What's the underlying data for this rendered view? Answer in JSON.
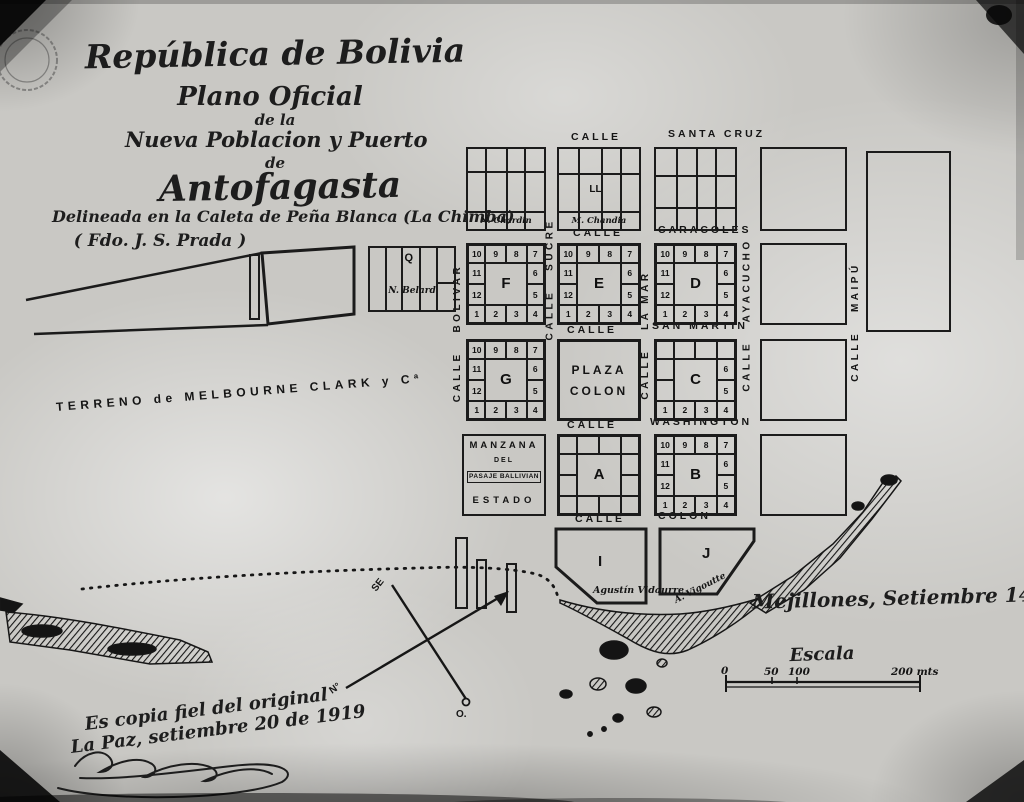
{
  "title": {
    "country": "República de Bolivia",
    "line2": "Plano Oficial",
    "line3": "de la",
    "line4": "Nueva Poblacion y Puerto",
    "line5": "de",
    "city": "Antofagasta",
    "subtitle": "Delineada en la Caleta de Peña Blanca (La Chimba)",
    "signed": "( Fdo. J. S. Prada )"
  },
  "region_label": "TERRENO de MELBOURNE CLARK y Cª",
  "streets": {
    "h": [
      {
        "l": "CALLE",
        "r": "SANTA CRUZ"
      },
      {
        "l": "CALLE",
        "r": "CARACOLES"
      },
      {
        "l": "CALLE",
        "r": "SAN MARTIN"
      },
      {
        "l": "CALLE",
        "r": "WASHINGTON"
      },
      {
        "l": "CALLE",
        "r": "COLON"
      }
    ],
    "v": [
      {
        "name": "CALLE   BOLIVAR"
      },
      {
        "name": "CALLE   SUCRE"
      },
      {
        "name": "CALLE   LA MAR"
      },
      {
        "name": "CALLE   AYACUCHO"
      },
      {
        "name": "CALLE   MAIPÚ"
      }
    ]
  },
  "plaza": {
    "l1": "PLAZA",
    "l2": "COLON"
  },
  "lots": {
    "top": [
      "10",
      "9",
      "8",
      "7"
    ],
    "left": [
      "11",
      "12"
    ],
    "right": [
      "6",
      "5"
    ],
    "bottom": [
      "1",
      "2",
      "3",
      "4"
    ]
  },
  "blocks": {
    "f": "F",
    "e": "E",
    "d": "D",
    "g": "G",
    "c": "C",
    "a": "A",
    "b": "B",
    "i": "I",
    "j": "J",
    "q": "Q",
    "ll": "LL"
  },
  "owners": {
    "chardin": "N. Chardin",
    "chandia": "M. Chandia",
    "belard": "N. Belard",
    "vidaurre": "Agustín Vidaurre",
    "vigoutte": "A. Vigoutte"
  },
  "state_block": {
    "l1": "MANZANA",
    "l2": "DEL",
    "l3": "PASAJE BALLIVIAN",
    "l4": "ESTADO"
  },
  "annotations": {
    "date_place": "Mejillones, Setiembre 14 de 1869",
    "copy1": "Es copia fiel del original",
    "copy2": "La Paz, setiembre 20 de 1919"
  },
  "scale_bar": {
    "label": "Escala",
    "t0": "0",
    "t50": "50",
    "t100": "100",
    "t200": "200 mts"
  },
  "compass": {
    "se": "SE",
    "n": "N°",
    "o": "O."
  },
  "colors": {
    "ink": "#161616",
    "paper": "#c9c8c4"
  }
}
